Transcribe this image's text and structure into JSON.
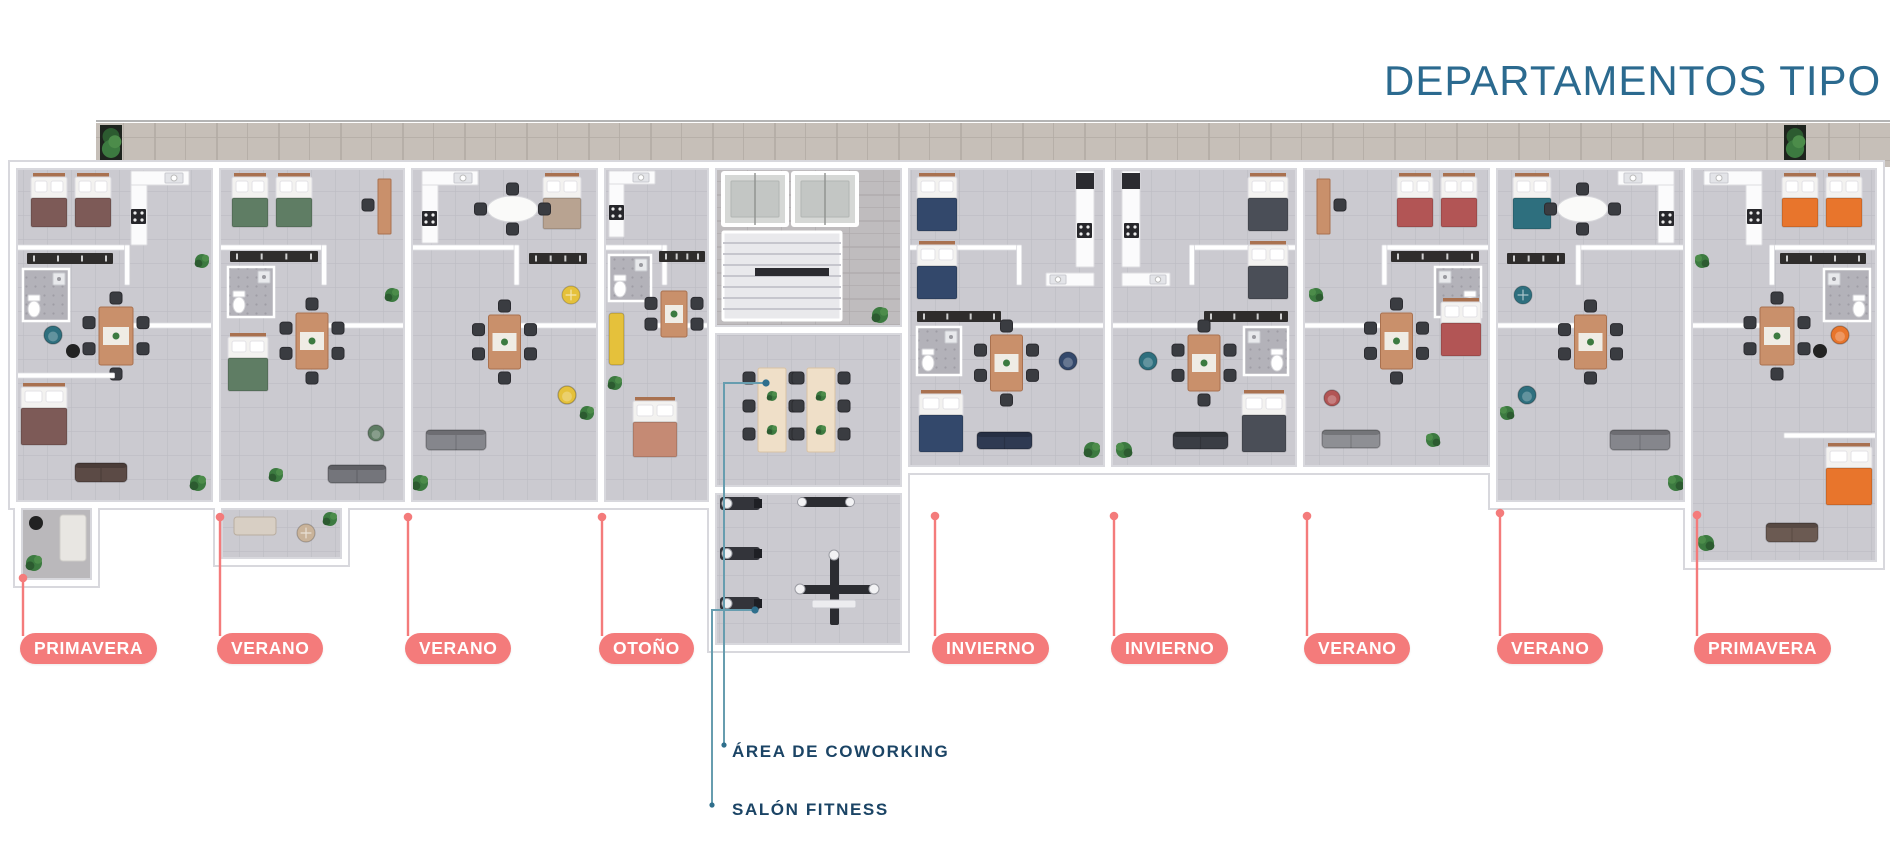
{
  "title": "DEPARTAMENTOS TIPO",
  "annotations": {
    "coworking": {
      "label": "ÁREA DE COWORKING",
      "dot": [
        766,
        383
      ],
      "elbow": [
        724,
        383
      ],
      "end": [
        724,
        745
      ]
    },
    "fitness": {
      "label": "SALÓN FITNESS",
      "dot": [
        755,
        610
      ],
      "elbow": [
        712,
        610
      ],
      "end": [
        712,
        805
      ]
    }
  },
  "palette": {
    "pill": "#F47B7B",
    "pill_text": "#FFFFFF",
    "title": "#2B6A8F",
    "annotation_text": "#1B4465",
    "teal_line": "#679DAF",
    "teal_dot": "#2F6F8C",
    "floor": "#CBCAD0",
    "grout": "#BDBCC3",
    "wall": "#FFFFFF",
    "wall_edge": "#D8D8DD",
    "terrace": "#C6BFB8",
    "terrace_grout": "#B2ABA4",
    "stone": "#BFBCBE",
    "wood": "#C9906B",
    "wood_dark": "#A9714F",
    "cream": "#EFDFC8",
    "dark": "#2B2B30",
    "chair": "#3A3C41",
    "plant": "#3C7A40"
  },
  "units": [
    {
      "label": "PRIMAVERA",
      "x": 13,
      "w": 203,
      "bottom": 505,
      "type": "end",
      "flip": false,
      "bed": "#7D5A57",
      "accent": "#2E6F7E",
      "sofa": "#5B4A45",
      "line": {
        "x": 23,
        "dotY": 578
      },
      "pill": {
        "left": 20,
        "top": 633
      }
    },
    {
      "label": "VERANO",
      "x": 216,
      "w": 192,
      "bottom": 505,
      "type": "std",
      "flip": false,
      "bed": "#5F7D64",
      "accent": "#5F7D64",
      "sofa": "#74757B",
      "line": {
        "x": 220,
        "dotY": 517
      },
      "pill": {
        "left": 217,
        "top": 633
      }
    },
    {
      "label": "VERANO",
      "x": 408,
      "w": 193,
      "bottom": 505,
      "type": "living",
      "flip": false,
      "bed": "#B8A391",
      "accent": "#E5C13B",
      "sofa": "#85868C",
      "line": {
        "x": 408,
        "dotY": 517
      },
      "pill": {
        "left": 405,
        "top": 633
      }
    },
    {
      "label": "OTOÑO",
      "x": 601,
      "w": 111,
      "bottom": 505,
      "type": "compact",
      "flip": false,
      "bed": "#C58A74",
      "accent": "#E5C13B",
      "sofa": "#E5C13B",
      "line": {
        "x": 602,
        "dotY": 517
      },
      "pill": {
        "left": 599,
        "top": 633
      }
    },
    {
      "label": "INVIERNO",
      "x": 905,
      "w": 203,
      "bottom": 470,
      "type": "pair",
      "flip": false,
      "bed": "#33486B",
      "accent": "#33486B",
      "sofa": "#2F3A52",
      "line": {
        "x": 935,
        "dotY": 516
      },
      "pill": {
        "left": 932,
        "top": 633
      }
    },
    {
      "label": "INVIERNO",
      "x": 1108,
      "w": 192,
      "bottom": 470,
      "type": "pair",
      "flip": true,
      "bed": "#4A4E57",
      "accent": "#2E6F7E",
      "sofa": "#3A3D44",
      "line": {
        "x": 1114,
        "dotY": 516
      },
      "pill": {
        "left": 1111,
        "top": 633
      }
    },
    {
      "label": "VERANO",
      "x": 1300,
      "w": 193,
      "bottom": 470,
      "type": "std",
      "flip": true,
      "bed": "#B25555",
      "accent": "#B25555",
      "sofa": "#8E8F94",
      "line": {
        "x": 1307,
        "dotY": 516
      },
      "pill": {
        "left": 1304,
        "top": 633
      }
    },
    {
      "label": "VERANO",
      "x": 1493,
      "w": 195,
      "bottom": 505,
      "type": "living",
      "flip": true,
      "bed": "#2E6F7E",
      "accent": "#2E6F7E",
      "sofa": "#85868C",
      "line": {
        "x": 1500,
        "dotY": 513
      },
      "pill": {
        "left": 1497,
        "top": 633
      }
    },
    {
      "label": "PRIMAVERA",
      "x": 1688,
      "w": 192,
      "bottom": 565,
      "type": "end",
      "flip": true,
      "bed": "#E8752C",
      "accent": "#E8752C",
      "sofa": "#6B5A52",
      "line": {
        "x": 1697,
        "dotY": 515
      },
      "pill": {
        "left": 1694,
        "top": 633
      }
    }
  ],
  "core": {
    "x": 712,
    "w": 193,
    "corridor_bottom": 330,
    "coworking_bottom": 490,
    "gym_bottom": 648
  },
  "terrace": {
    "x": 96,
    "y": 123,
    "w": 1794,
    "h": 44
  },
  "extras": {
    "patio_unit1": {
      "x": 18,
      "y": 505,
      "w": 77,
      "h": 78
    },
    "balcony_unit2": {
      "x": 218,
      "y": 505,
      "w": 127,
      "h": 57
    }
  }
}
